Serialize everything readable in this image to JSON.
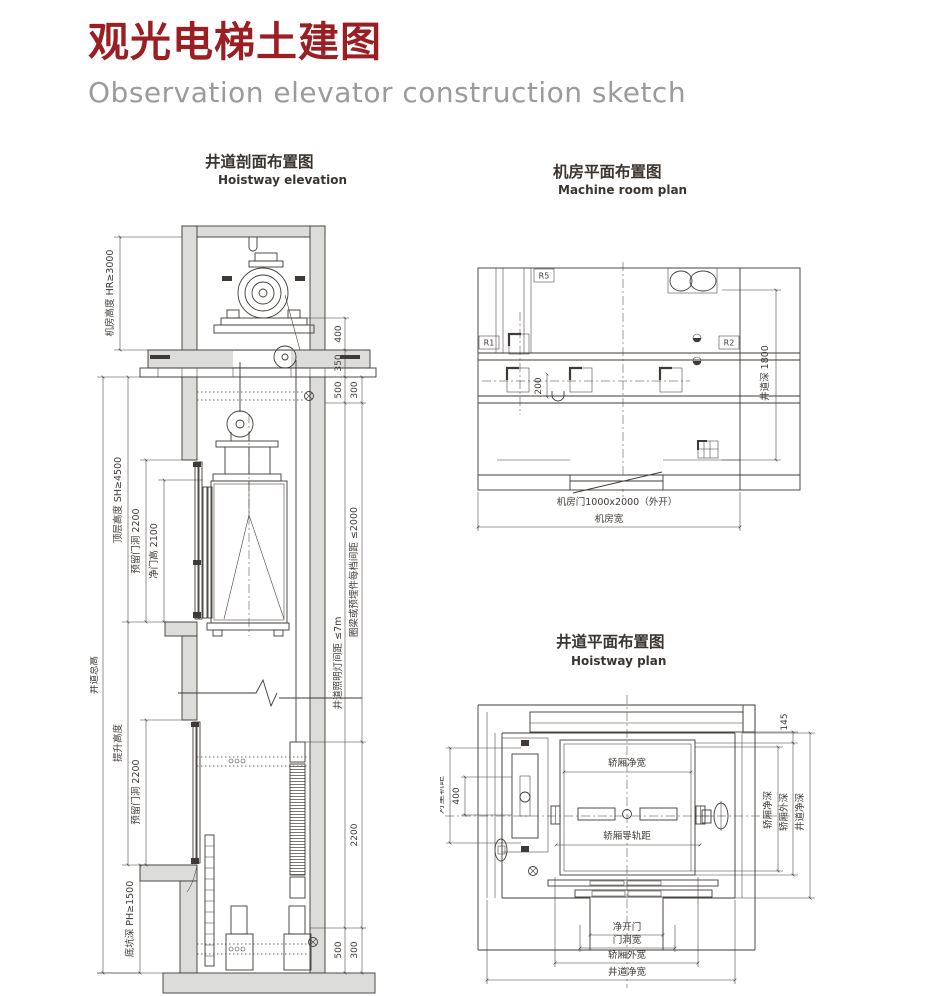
{
  "page": {
    "title": "观光电梯土建图",
    "subtitle": "Observation elevator construction sketch"
  },
  "colors": {
    "accent_red": "#9b1e23",
    "subtitle_gray": "#9b9b9b",
    "line": "#3f3a36",
    "wall_fill": "#dcdcda"
  },
  "elevation": {
    "title": "井道剖面布置图",
    "subtitle": "Hoistway elevation",
    "dims": {
      "machine_room_height": "机房高度 HR≥3000",
      "total_height": "井道总高",
      "top_floor_height": "顶层高度 SH≥4500",
      "door_opening_top": "预留门洞 2200",
      "clear_door_height": "净门高 2100",
      "lifting_height": "提升高度",
      "door_opening_bottom": "预留门洞 2200",
      "pit_depth": "底坑深 PH≥1500",
      "d400": "400",
      "d350": "350",
      "d500_top": "500",
      "d300_top": "300",
      "lighting_spacing": "井道照明灯间距 ≤7m",
      "embed_spacing": "圈梁或预埋件每档间距 ≤2000",
      "d2200": "2200",
      "d500_bottom": "500",
      "d300_bottom": "300"
    }
  },
  "machine_room": {
    "title": "机房平面布置图",
    "subtitle": "Machine room plan",
    "labels": {
      "r1": "R1",
      "r2": "R2",
      "r5": "R5",
      "d200": "200"
    },
    "dims": {
      "hoistway_depth": "井道深 1800",
      "door": "机房门1000x2000（外开）",
      "room_width": "机房宽"
    }
  },
  "hoistway_plan": {
    "title": "井道平面布置图",
    "subtitle": "Hoistway plan",
    "dims": {
      "car_clear_width": "轿厢净宽",
      "car_rail_gauge": "轿厢导轨距",
      "cwt_rail_gauge": "对重轨距",
      "d400": "400",
      "d145": "145",
      "car_clear_depth": "轿厢净深",
      "car_outer_depth": "轿厢外深",
      "hoistway_clear_depth": "井道净深",
      "clear_door_opening": "净开门",
      "door_opening_width": "门洞宽",
      "car_outer_width": "轿厢外宽",
      "hoistway_clear_width": "井道净宽"
    }
  }
}
